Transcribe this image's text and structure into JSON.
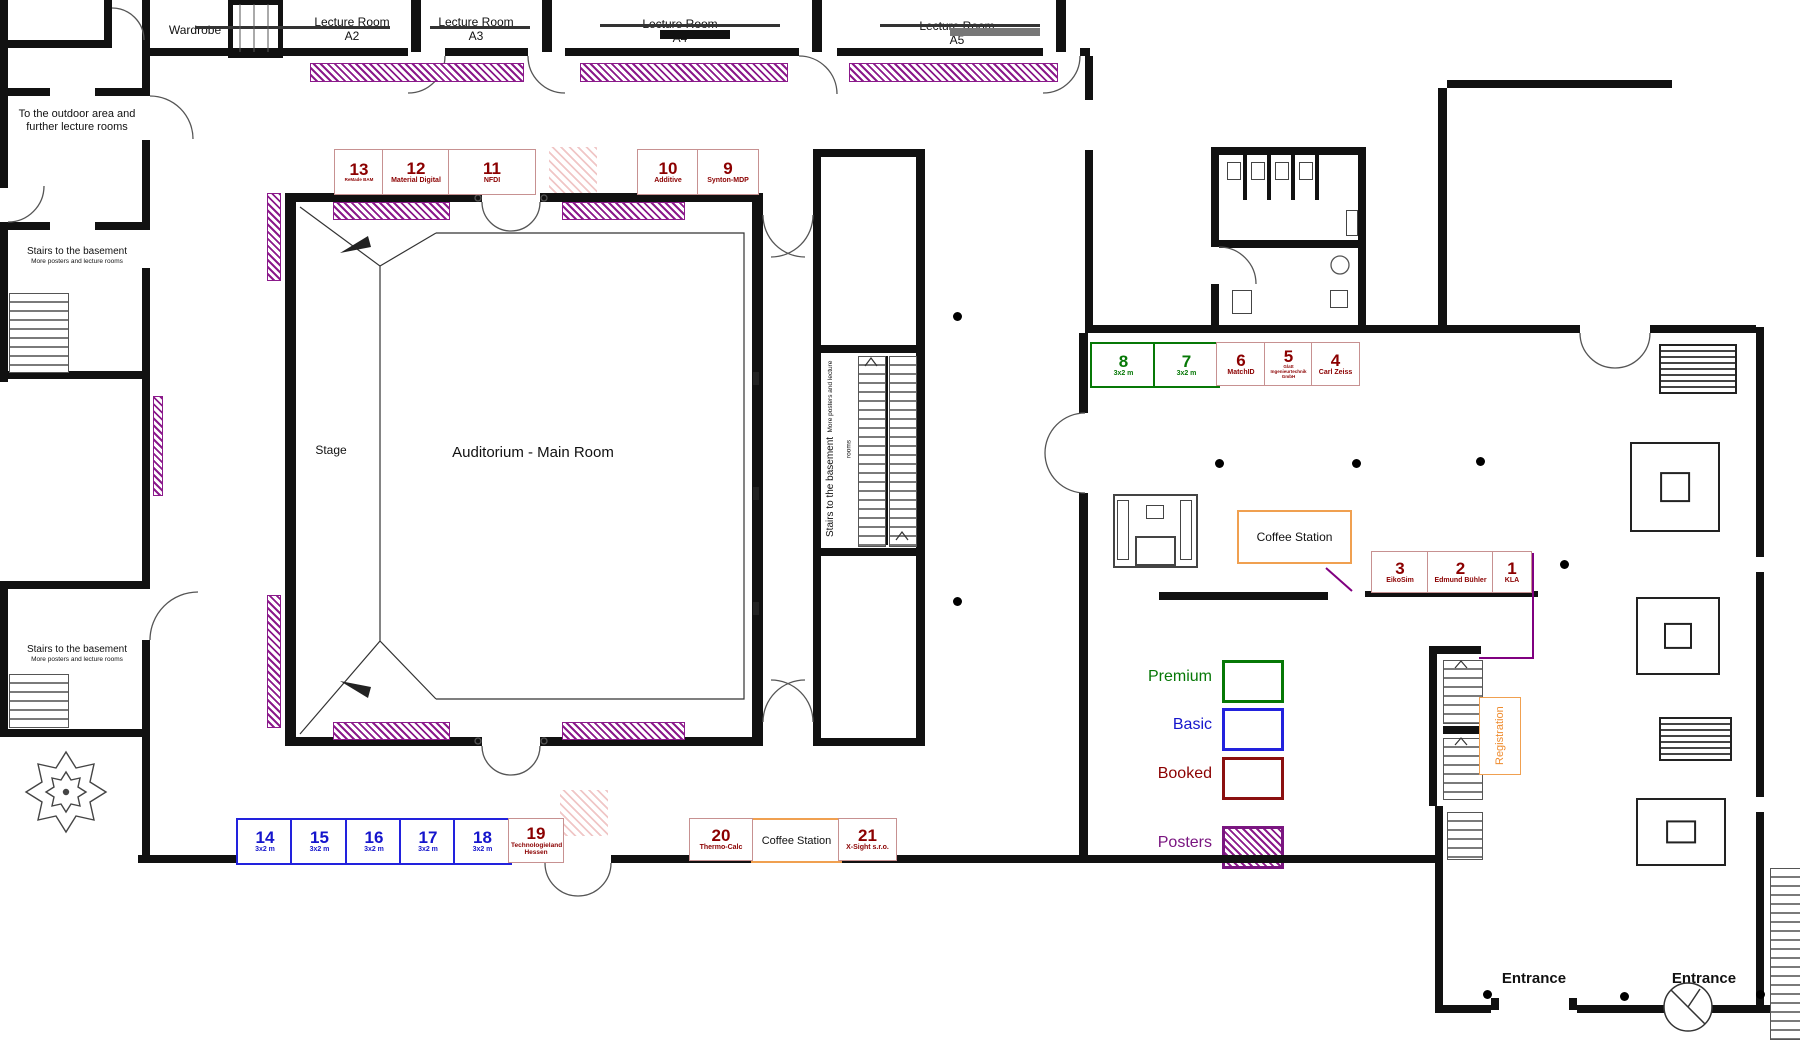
{
  "rooms": {
    "wardrobe": "Wardrobe",
    "a2": {
      "l1": "Lecture Room",
      "l2": "A2"
    },
    "a3": {
      "l1": "Lecture Room",
      "l2": "A3"
    },
    "a4": {
      "l1": "Lecture Room",
      "l2": "A4"
    },
    "a5": {
      "l1": "Lecture Room",
      "l2": "A5"
    },
    "outdoor": {
      "l1": "To the outdoor area and",
      "l2": "further lecture rooms"
    },
    "stairs": {
      "l1": "Stairs to the basement",
      "l2": "More posters and lecture rooms"
    },
    "stage": "Stage",
    "auditorium": "Auditorium - Main Room",
    "coffee": "Coffee Station",
    "registration": "Registration",
    "entrance": "Entrance"
  },
  "booths": {
    "b1": {
      "num": "1",
      "sub": "KLA"
    },
    "b2": {
      "num": "2",
      "sub": "Edmund Bühler"
    },
    "b3": {
      "num": "3",
      "sub": "EikoSim"
    },
    "b4": {
      "num": "4",
      "sub": "Carl Zeiss"
    },
    "b5": {
      "num": "5",
      "sub": "Glatt Ingenieurtechnik GmbH"
    },
    "b6": {
      "num": "6",
      "sub": "MatchID"
    },
    "b7": {
      "num": "7",
      "sub": "3x2 m"
    },
    "b8": {
      "num": "8",
      "sub": "3x2 m"
    },
    "b9": {
      "num": "9",
      "sub": "Synton-MDP"
    },
    "b10": {
      "num": "10",
      "sub": "Additive"
    },
    "b11": {
      "num": "11",
      "sub": "NFDI"
    },
    "b12": {
      "num": "12",
      "sub": "Material Digital"
    },
    "b13": {
      "num": "13",
      "sub": "ReMade BAM"
    },
    "b14": {
      "num": "14",
      "sub": "3x2 m"
    },
    "b15": {
      "num": "15",
      "sub": "3x2 m"
    },
    "b16": {
      "num": "16",
      "sub": "3x2 m"
    },
    "b17": {
      "num": "17",
      "sub": "3x2 m"
    },
    "b18": {
      "num": "18",
      "sub": "3x2 m"
    },
    "b19": {
      "num": "19",
      "sub": "Technologieland Hessen"
    },
    "b20": {
      "num": "20",
      "sub": "Thermo-Calc"
    },
    "b21": {
      "num": "21",
      "sub": "X-Sight s.r.o."
    }
  },
  "legend": {
    "items": [
      {
        "label": "Premium",
        "color": "#067806",
        "style": "outline"
      },
      {
        "label": "Basic",
        "color": "#1515cc",
        "style": "outline"
      },
      {
        "label": "Booked",
        "color": "#8b0000",
        "style": "outline"
      },
      {
        "label": "Posters",
        "color": "#7a1680",
        "style": "hatch"
      }
    ]
  },
  "colors": {
    "premium": "#067806",
    "basic": "#1515cc",
    "booked": "#8b0000",
    "posters": "#8b1a8b",
    "accent_orange": "#f0a050"
  }
}
